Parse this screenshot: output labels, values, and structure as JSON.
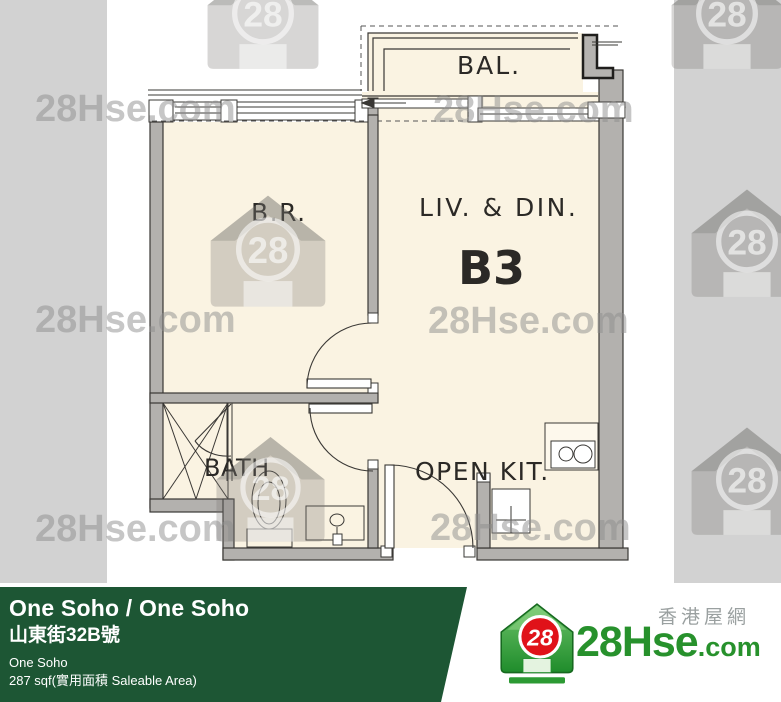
{
  "watermark": {
    "text": "28Hse.com",
    "number": "28"
  },
  "floor_plan": {
    "balcony_label": "BAL.",
    "bedroom_label": "B.R.",
    "living_dining_label": "LIV. & DIN.",
    "unit_label": "B3",
    "bath_label": "BATH",
    "kitchen_label": "OPEN KIT."
  },
  "footer": {
    "title": "One Soho / One Soho",
    "address_zh": "山東街32B號",
    "estate_name": "One Soho",
    "area": "287 sqf(實用面積 Saleable Area)",
    "bar_color": "#1d5634"
  },
  "brand": {
    "site_name_zh": "香港屋網",
    "logo_text": "28Hse",
    "logo_tld": ".com",
    "logo_number": "28",
    "green": "#27912c",
    "red": "#e01219"
  }
}
